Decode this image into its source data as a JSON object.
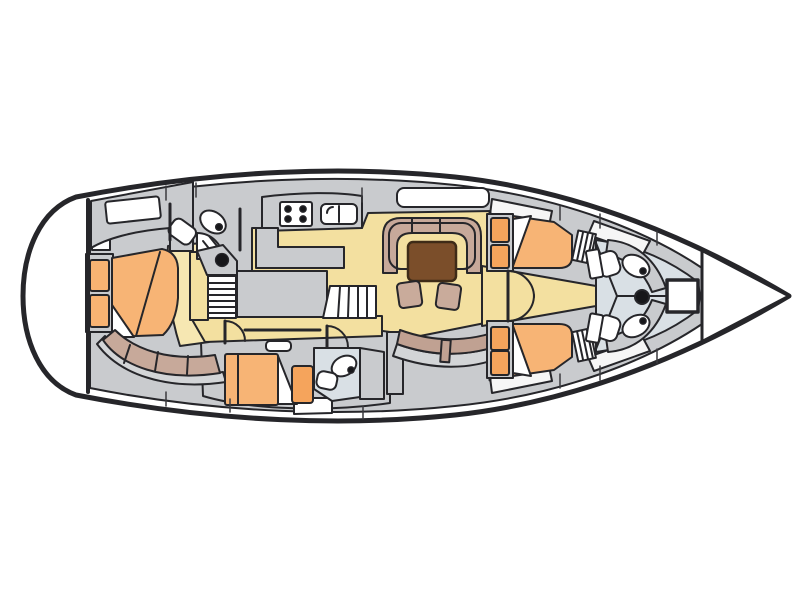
{
  "diagram": {
    "type": "yacht-interior-deck-plan",
    "orientation": {
      "bow": "right",
      "stern": "left"
    },
    "inventory": {
      "cabins": 4,
      "berths": 4,
      "toilets": 4,
      "sinks": 4,
      "showers": 1,
      "saloon_tables": 1,
      "stools": 2,
      "companionway_steps": 2,
      "stove_burners": 4,
      "bow_hatches": 1,
      "mast_marks": 1
    }
  },
  "colors": {
    "outline": "#26262a",
    "hull": "#ffffff",
    "furniture": "#c9cbce",
    "floor": "#f3e0a0",
    "floor_light": "#f6e7b2",
    "bed": "#f7b475",
    "cushion": "#f5a45c",
    "shelf": "#f8b372",
    "sofa": "#c7a99a",
    "sofa2": "#c0a192",
    "trim": "#d3d5d7",
    "table": "#7b4e2a",
    "stool": "#c9ab9b",
    "head_floor": "#d9e0e5",
    "white": "#ffffff",
    "dot": "#17171a",
    "hatch_border": "#595d61",
    "wedge": "#f6f6f6"
  }
}
